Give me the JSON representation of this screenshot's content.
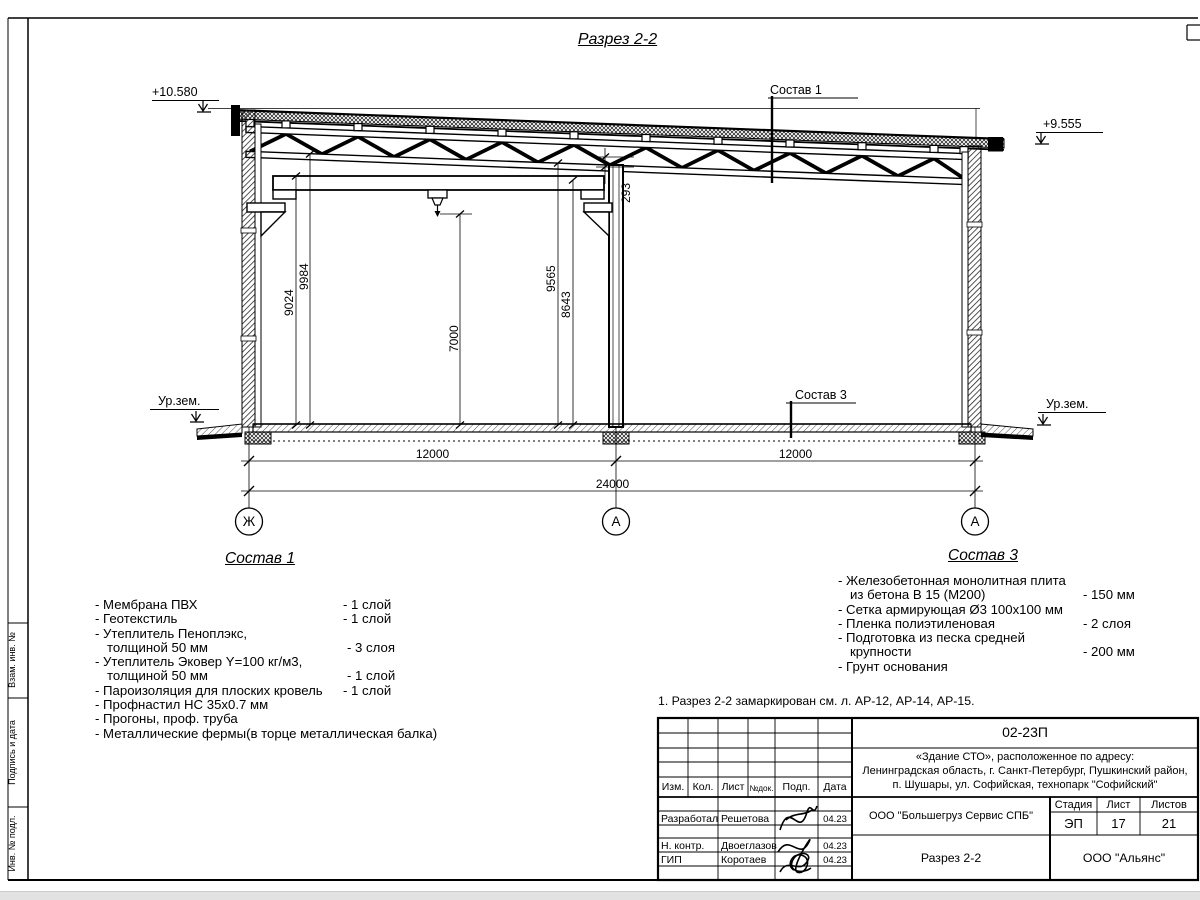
{
  "page": {
    "title": "Разрез 2-2"
  },
  "drawing": {
    "elevation_left": "+10.580",
    "elevation_right": "+9.555",
    "ground_label_left": "Ур.зем.",
    "ground_label_right": "Ур.зем.",
    "callout_roof": "Состав 1",
    "callout_floor": "Состав 3",
    "dims": {
      "h9024": "9024",
      "h9984": "9984",
      "h7000": "7000",
      "h9565": "9565",
      "h8643": "8643",
      "gap293": "293",
      "span_left": "12000",
      "span_right": "12000",
      "total": "24000"
    },
    "axes": [
      "Ж",
      "А",
      "А"
    ]
  },
  "sostav1": {
    "title": "Состав 1",
    "items": [
      {
        "name": "- Мембрана ПВХ",
        "qty": "- 1 слой"
      },
      {
        "name": "- Геотекстиль",
        "qty": "- 1 слой"
      },
      {
        "name": "- Утеплитель Пеноплэкс,",
        "qty": ""
      },
      {
        "name": "толщиной 50 мм",
        "qty": "- 3 слоя"
      },
      {
        "name": "- Утеплитель Эковер Y=100 кг/м3,",
        "qty": ""
      },
      {
        "name": "толщиной 50 мм",
        "qty": "- 1 слой"
      },
      {
        "name": "- Пароизоляция для плоских кровель",
        "qty": "- 1 слой"
      },
      {
        "name": "- Профнастил НС 35х0.7 мм",
        "qty": ""
      },
      {
        "name": "- Прогоны, проф. труба",
        "qty": ""
      },
      {
        "name": "- Металлические фермы(в торце металлическая балка)",
        "qty": ""
      }
    ]
  },
  "sostav3": {
    "title": "Состав 3",
    "items": [
      {
        "name": "- Железобетонная  монолитная плита",
        "qty": ""
      },
      {
        "name": "из бетона В 15 (М200)",
        "qty": "- 150 мм"
      },
      {
        "name": "- Сетка армирующая Ø3 100х100 мм",
        "qty": ""
      },
      {
        "name": "- Пленка полиэтиленовая",
        "qty": "- 2 слоя"
      },
      {
        "name": "- Подготовка из песка средней",
        "qty": ""
      },
      {
        "name": "крупности",
        "qty": "- 200 мм"
      },
      {
        "name": "- Грунт основания",
        "qty": ""
      }
    ]
  },
  "note": "1. Разрез 2-2 замаркирован см. л. АР-12, АР-14, АР-15.",
  "titleblock": {
    "doc_number": "02-23П",
    "address_line1": "«Здание СТО», расположенное по адресу:",
    "address_line2": "Ленинградская область, г. Санкт-Петербург, Пушкинский район,",
    "address_line3": "п. Шушары, ул. Софийская, технопарк \"Софийский\"",
    "col_izm": "Изм.",
    "col_kol": "Кол.",
    "col_list": "Лист",
    "col_ndok": "№док.",
    "col_podp": "Подп.",
    "col_data": "Дата",
    "rows": [
      {
        "role": "Разработал",
        "name": "Решетова",
        "date": "04.23"
      },
      {
        "role": "Н. контр.",
        "name": "Двоеглазов",
        "date": "04.23"
      },
      {
        "role": "ГИП",
        "name": "Коротаев",
        "date": "04.23"
      }
    ],
    "contractor": "ООО \"Большегруз Сервис СПБ\"",
    "stage_label": "Стадия",
    "sheet_label": "Лист",
    "sheets_label": "Листов",
    "stage": "ЭП",
    "sheet": "17",
    "sheets": "21",
    "drawing_name": "Разрез 2-2",
    "company": "ООО \"Альянс\""
  },
  "frame": {
    "side_labels": [
      "Взам. инв. №",
      "Подпись и дата",
      "Инв. № подл."
    ]
  },
  "colors": {
    "line": "#000000",
    "paper": "#ffffff",
    "scrollbar": "#e2e2e2"
  }
}
